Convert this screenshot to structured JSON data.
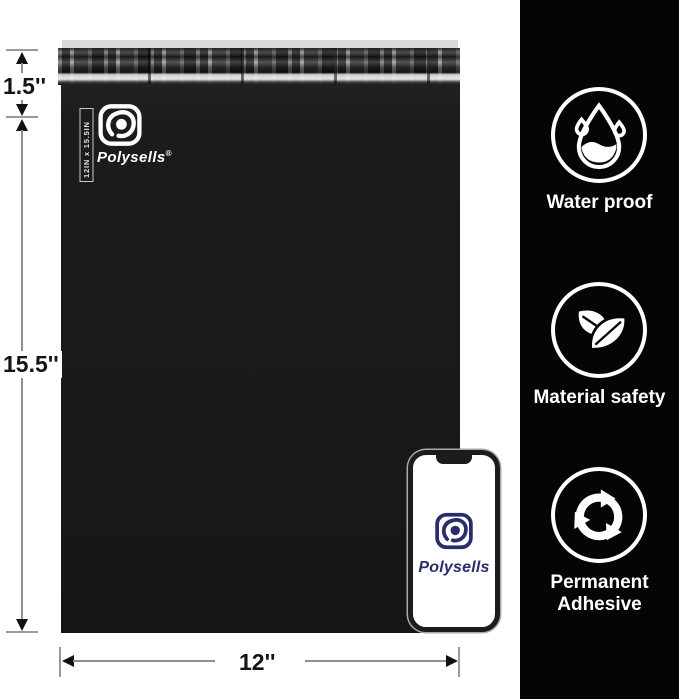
{
  "bag": {
    "size_label": "12IN x 15.5IN",
    "brand": "Polysells",
    "registered_mark": "®"
  },
  "dimensions": {
    "flap_height": "1.5''",
    "bag_height": "15.5''",
    "bag_width": "12''"
  },
  "phone": {
    "brand": "Polysells"
  },
  "sidebar": {
    "features": [
      {
        "label": "Water proof",
        "icon": "water-drop-icon"
      },
      {
        "label": "Material safety",
        "icon": "leaves-icon"
      },
      {
        "label": "Permanent Adhesive",
        "icon": "recycle-icon"
      }
    ]
  },
  "colors": {
    "sidebar_bg": "#050505",
    "bag_body": "#1b1b1b",
    "brand_navy": "#292d6d",
    "dimension_line": "#8f8f8f",
    "text": "#141414"
  }
}
